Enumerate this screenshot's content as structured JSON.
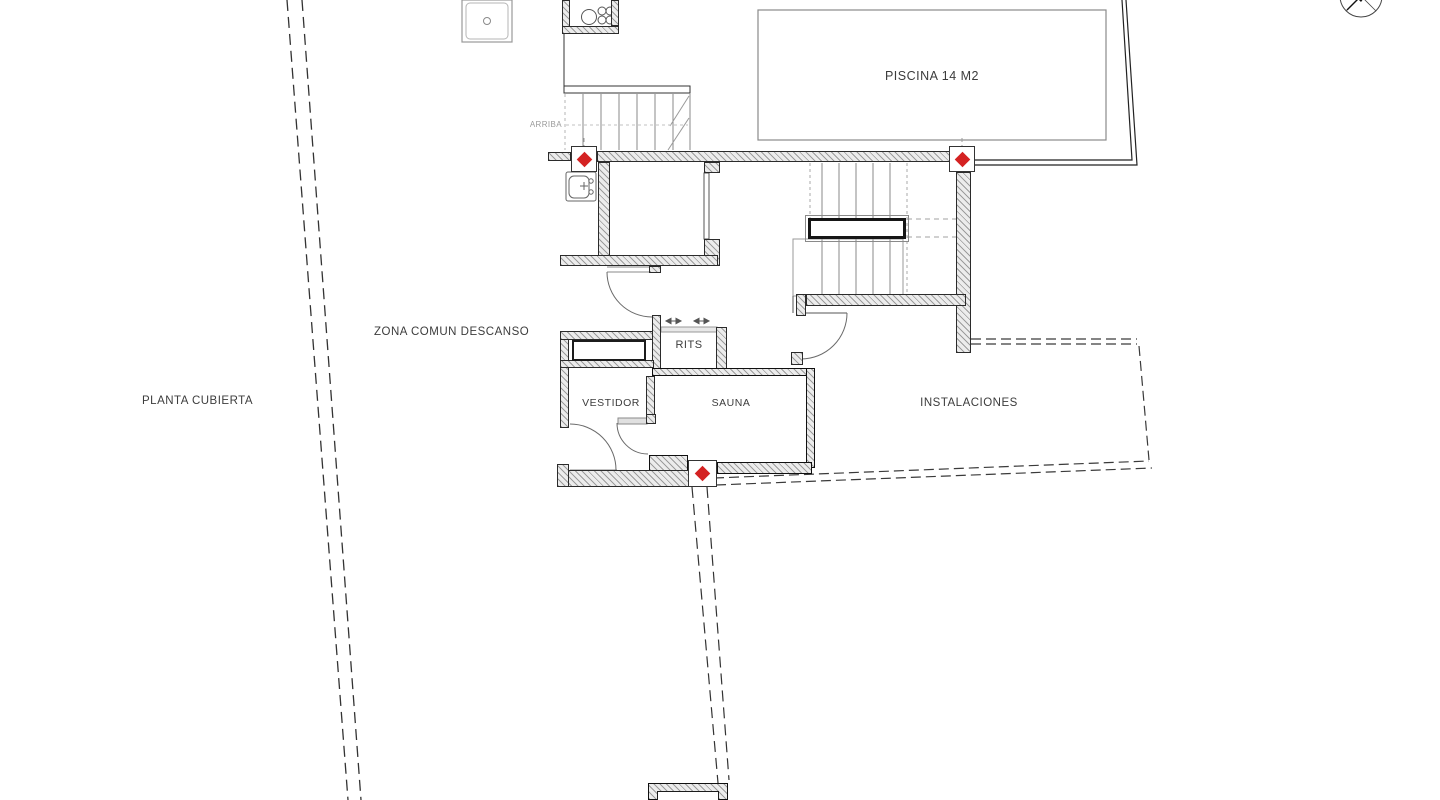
{
  "drawing": {
    "title": "PLANTA CUBIERTA",
    "labels": {
      "plan_title": "PLANTA CUBIERTA",
      "zone_common": "ZONA COMUN DESCANSO",
      "pool": "PISCINA 14 M2",
      "stairs_up": "ARRIBA",
      "rits": "RITS",
      "dressing_room": "VESTIDOR",
      "sauna": "SAUNA",
      "installations": "INSTALACIONES"
    }
  },
  "icons": {
    "compass": "compass-north-icon",
    "column_marker": "column-marker-icon",
    "sink": "sink-icon",
    "shower_tray": "shower-tray-icon",
    "boiler_pipes": "pipes-circles-icon",
    "lockers": "lockers-circles-icon",
    "vent_arrows": "vent-arrows-icon"
  },
  "colors": {
    "marker_red": "#d42222",
    "wall_fill": "#ececec",
    "wall_hatch": "#9c9c9c",
    "text": "#3c3c3c",
    "line_dark": "#222222",
    "line_light": "#8a8a8a"
  }
}
